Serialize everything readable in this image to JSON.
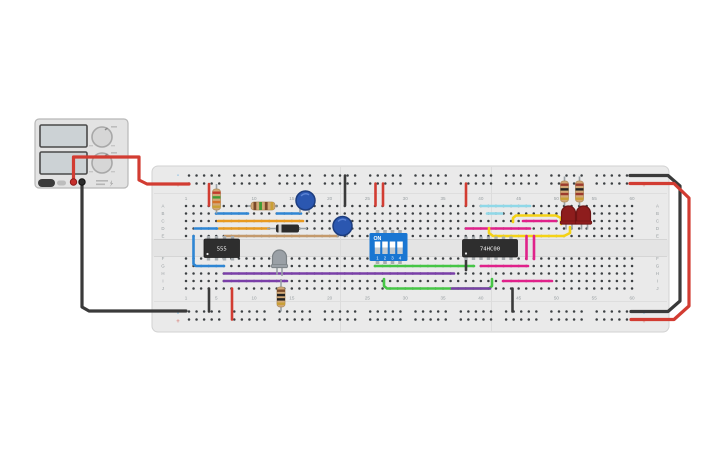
{
  "app": {
    "description": "breadboard circuit with 555 timer, 74HC00, DIP switch, LEDs and power supply"
  },
  "breadboard": {
    "row_labels": [
      "A",
      "B",
      "C",
      "D",
      "E",
      "F",
      "G",
      "H",
      "I",
      "J"
    ],
    "column_numbers": [
      "1",
      "5",
      "10",
      "15",
      "20",
      "25",
      "30",
      "35",
      "40",
      "45",
      "50",
      "55",
      "60"
    ],
    "markers": {
      "minus": "-",
      "plus": "+"
    }
  },
  "power_supply": {
    "display_count": 2,
    "knob_count": 2,
    "terminals": [
      "positive-red",
      "negative-black"
    ]
  },
  "components": {
    "ic1_label": "555",
    "ic2_label": "74HC00",
    "dip_switch": {
      "on_label": "ON",
      "positions": [
        "1",
        "2",
        "3",
        "4"
      ]
    }
  },
  "colors": {
    "board": "#eaeaea",
    "board_edge": "#d2d2d2",
    "hole": "#3c4043",
    "label": "#9aa0a3",
    "psu_body": "#e3e3e3",
    "psu_edge": "#b8b8b8",
    "psu_screen": "#ccd2d5",
    "red": "#d23c32",
    "black": "#3a3a3a",
    "blue": "#2e86d4",
    "cyan": "#8fd8e8",
    "orange": "#e89a20",
    "tan": "#c49a6c",
    "purple": "#7a3fa8",
    "green": "#46c646",
    "magenta": "#e0218a",
    "yellow": "#f4d216",
    "chip": "#2e2e2e",
    "chip_pin": "#a8adb0",
    "dip_blue": "#1976d2",
    "cap_blue": "#2b57b0",
    "cap_edge": "#1d3d7f",
    "led_red": "#8e1d1d",
    "led_gray": "#9aa0a6",
    "resistor_body": "#d2a876",
    "gold": "#c9a035",
    "leg": "#9aa2a6"
  },
  "wires": [
    {
      "name": "psu-positive-wire",
      "color": "red",
      "w": 3.2,
      "pts": [
        [
          73.5,
          180
        ],
        [
          73.5,
          157
        ],
        [
          139,
          157
        ],
        [
          139,
          180
        ],
        [
          147,
          184
        ],
        [
          189,
          184
        ]
      ]
    },
    {
      "name": "psu-negative-wire",
      "color": "black",
      "w": 3.2,
      "pts": [
        [
          82,
          186
        ],
        [
          82,
          307
        ],
        [
          89,
          311
        ],
        [
          186,
          311
        ]
      ]
    },
    {
      "name": "wrap-black-wire",
      "color": "black",
      "w": 3.2,
      "pts": [
        [
          630,
          175.5
        ],
        [
          668,
          175.5
        ],
        [
          680,
          186
        ],
        [
          680,
          301
        ],
        [
          668,
          311.5
        ],
        [
          631,
          311.5
        ]
      ]
    },
    {
      "name": "jumper-red-top-left",
      "color": "red",
      "w": 2.6,
      "pts": [
        [
          209,
          184
        ],
        [
          209,
          205.5
        ]
      ]
    },
    {
      "name": "jumper-black-col21",
      "color": "black",
      "w": 2.6,
      "pts": [
        [
          345,
          175.5
        ],
        [
          345,
          205.5
        ]
      ]
    },
    {
      "name": "jumper-red-col26a",
      "color": "red",
      "w": 2.6,
      "pts": [
        [
          375.5,
          183.5
        ],
        [
          375.5,
          205.5
        ]
      ]
    },
    {
      "name": "jumper-red-col26b",
      "color": "red",
      "w": 2.6,
      "pts": [
        [
          383,
          183.5
        ],
        [
          383,
          205.5
        ]
      ]
    },
    {
      "name": "jumper-red-col38",
      "color": "red",
      "w": 2.6,
      "pts": [
        [
          466,
          183.5
        ],
        [
          466,
          205.5
        ]
      ]
    },
    {
      "name": "wire-blue-rowB-left",
      "color": "blue",
      "w": 2.6,
      "pts": [
        [
          216,
          213.5
        ],
        [
          248,
          213.5
        ]
      ]
    },
    {
      "name": "wire-blue-rowB-right",
      "color": "blue",
      "w": 2.6,
      "pts": [
        [
          277,
          213.5
        ],
        [
          301,
          213.5
        ]
      ]
    },
    {
      "name": "wire-orange-rowC",
      "color": "orange",
      "w": 2.6,
      "pts": [
        [
          218,
          221
        ],
        [
          303,
          221
        ]
      ]
    },
    {
      "name": "wire-orange-rowD",
      "color": "orange",
      "w": 2.6,
      "pts": [
        [
          219,
          228.5
        ],
        [
          269,
          228.5
        ]
      ]
    },
    {
      "name": "wire-blue-rowD-left",
      "color": "blue",
      "w": 2.6,
      "pts": [
        [
          195,
          228.5
        ],
        [
          217,
          228.5
        ]
      ]
    },
    {
      "name": "wire-tan-rowE",
      "color": "tan",
      "w": 2.6,
      "pts": [
        [
          225,
          236
        ],
        [
          338,
          236
        ]
      ]
    },
    {
      "name": "wire-blue-vertical-left",
      "color": "blue",
      "w": 2.6,
      "pts": [
        [
          193.5,
          236
        ],
        [
          193.5,
          264
        ],
        [
          196,
          266
        ],
        [
          224,
          266
        ]
      ]
    },
    {
      "name": "wire-purple-rowH",
      "color": "purple",
      "w": 2.6,
      "pts": [
        [
          224,
          273.5
        ],
        [
          454,
          273.5
        ]
      ]
    },
    {
      "name": "wire-purple-rowI",
      "color": "purple",
      "w": 2.6,
      "pts": [
        [
          224,
          281
        ],
        [
          287,
          281
        ]
      ]
    },
    {
      "name": "jumper-black-bottom-left",
      "color": "black",
      "w": 2.6,
      "pts": [
        [
          209,
          288.5
        ],
        [
          209,
          311.5
        ]
      ]
    },
    {
      "name": "jumper-red-bottom-left",
      "color": "red",
      "w": 2.6,
      "pts": [
        [
          232,
          288.5
        ],
        [
          232,
          319.5
        ]
      ]
    },
    {
      "name": "wire-green-rowG",
      "color": "green",
      "w": 2.6,
      "pts": [
        [
          375,
          266
        ],
        [
          474,
          266
        ]
      ]
    },
    {
      "name": "wire-green-u",
      "color": "green",
      "w": 2.6,
      "pts": [
        [
          384,
          279
        ],
        [
          384,
          286
        ],
        [
          387,
          288.5
        ],
        [
          489,
          288.5
        ],
        [
          492,
          286
        ],
        [
          492,
          279
        ]
      ]
    },
    {
      "name": "wire-purple-rowJ",
      "color": "purple",
      "w": 2.6,
      "pts": [
        [
          452,
          288.5
        ],
        [
          490,
          288.5
        ]
      ]
    },
    {
      "name": "jumper-black-col38",
      "color": "black",
      "w": 2.6,
      "pts": [
        [
          466,
          258.5
        ],
        [
          466,
          270
        ]
      ]
    },
    {
      "name": "jumper-black-col44",
      "color": "black",
      "w": 2.6,
      "pts": [
        [
          512.5,
          288.5
        ],
        [
          512.5,
          311.5
        ]
      ]
    },
    {
      "name": "wire-cyan-rowA",
      "color": "cyan",
      "w": 2.6,
      "pts": [
        [
          481,
          206
        ],
        [
          530,
          206
        ]
      ]
    },
    {
      "name": "wire-cyan-rowB",
      "color": "cyan",
      "w": 2.6,
      "pts": [
        [
          487,
          213.5
        ],
        [
          502,
          213.5
        ]
      ]
    },
    {
      "name": "wire-magenta-rowD",
      "color": "magenta",
      "w": 2.6,
      "pts": [
        [
          466,
          228.5
        ],
        [
          530,
          228.5
        ]
      ]
    },
    {
      "name": "wire-magenta-rowC",
      "color": "magenta",
      "w": 2.6,
      "pts": [
        [
          523,
          221
        ],
        [
          556,
          221
        ]
      ]
    },
    {
      "name": "wire-yellow-1",
      "color": "yellow",
      "w": 2.6,
      "pts": [
        [
          513,
          222
        ],
        [
          513,
          218
        ],
        [
          516,
          215.5
        ],
        [
          556,
          215.5
        ],
        [
          561,
          218
        ],
        [
          561,
          224
        ]
      ]
    },
    {
      "name": "wire-yellow-2",
      "color": "yellow",
      "w": 2.6,
      "pts": [
        [
          489,
          228
        ],
        [
          489,
          233
        ],
        [
          493,
          236
        ],
        [
          564,
          236
        ],
        [
          570,
          233
        ],
        [
          570,
          227
        ]
      ]
    },
    {
      "name": "wire-magenta-vert1",
      "color": "magenta",
      "w": 2.6,
      "pts": [
        [
          526.5,
          236
        ],
        [
          526.5,
          259
        ]
      ]
    },
    {
      "name": "wire-magenta-vert2",
      "color": "magenta",
      "w": 2.6,
      "pts": [
        [
          534,
          236
        ],
        [
          534,
          259
        ]
      ]
    },
    {
      "name": "wire-magenta-rowG",
      "color": "magenta",
      "w": 2.6,
      "pts": [
        [
          481,
          266
        ],
        [
          528,
          266
        ]
      ]
    },
    {
      "name": "wire-magenta-rowI",
      "color": "magenta",
      "w": 2.6,
      "pts": [
        [
          503,
          281
        ],
        [
          552,
          281
        ]
      ]
    },
    {
      "name": "wrap-red-wire",
      "color": "red",
      "w": 3.2,
      "pts": [
        [
          630,
          183.5
        ],
        [
          674,
          183.5
        ],
        [
          689,
          198
        ],
        [
          689,
          306
        ],
        [
          674,
          319.5
        ],
        [
          631,
          319.5
        ]
      ]
    }
  ],
  "resistors": [
    {
      "name": "resistor-top-left",
      "orient": "v",
      "x": 216.5,
      "lead1": 184,
      "lead2": 213.5,
      "body": 189,
      "blen": 21,
      "bands": [
        "#c23b2e",
        "#3f9b35",
        "#d4722a",
        "#c9a035"
      ]
    },
    {
      "name": "resistor-rowA",
      "orient": "h",
      "y": 206,
      "lead1": 248,
      "lead2": 278,
      "body": 251,
      "blen": 24,
      "bands": [
        "#7a4a2a",
        "#3f9b35",
        "#7a4a2a",
        "#c9a035"
      ]
    },
    {
      "name": "resistor-led1",
      "orient": "v",
      "x": 564.5,
      "lead1": 176.5,
      "lead2": 205.5,
      "body": 181,
      "blen": 21,
      "bands": [
        "#9c3b2e",
        "#222222",
        "#9c3b2e",
        "#c9a035"
      ]
    },
    {
      "name": "resistor-led2",
      "orient": "v",
      "x": 579.5,
      "lead1": 176.5,
      "lead2": 205.5,
      "body": 181,
      "blen": 21,
      "bands": [
        "#9c3b2e",
        "#222222",
        "#9c3b2e",
        "#c9a035"
      ]
    },
    {
      "name": "resistor-bottom",
      "orient": "v",
      "x": 281,
      "lead1": 279,
      "lead2": 311.5,
      "body": 287,
      "blen": 20,
      "bands": [
        "#7a4a2a",
        "#222222",
        "#222222",
        "#c9a035"
      ]
    }
  ],
  "capacitors": [
    {
      "name": "capacitor-1",
      "cx": 305.5,
      "cy": 200.5,
      "r": 9.5,
      "legs": [
        [
          300,
          208,
          213
        ],
        [
          309,
          208,
          213
        ]
      ]
    },
    {
      "name": "capacitor-2",
      "cx": 342.5,
      "cy": 226,
      "r": 9.5,
      "legs": [
        [
          338,
          233,
          237
        ],
        [
          347,
          233,
          237
        ]
      ]
    }
  ],
  "diode": {
    "name": "diode",
    "y": 228.5,
    "x1": 267,
    "x2": 307,
    "bx": 276,
    "bw": 23,
    "band_x": 278.5
  },
  "leds": [
    {
      "name": "led-gray",
      "x": 272.5,
      "y": 250,
      "wd": 14,
      "ht": 17.5,
      "fill": "#9aa0a6",
      "edge": "#7c8286",
      "legs": [
        [
          277,
          267,
          275
        ],
        [
          282,
          267,
          276
        ]
      ]
    },
    {
      "name": "led-red-1",
      "x": 561.5,
      "y": 206,
      "wd": 14,
      "ht": 18,
      "fill": "#8e1d1d",
      "edge": "#6e1414",
      "legs": [
        [
          566,
          223.5,
          229.5
        ],
        [
          572,
          223.5,
          229.5
        ]
      ]
    },
    {
      "name": "led-red-2",
      "x": 576.5,
      "y": 206,
      "wd": 14,
      "ht": 18,
      "fill": "#8e1d1d",
      "edge": "#6e1414",
      "legs": [
        [
          581.5,
          223.5,
          229.5
        ],
        [
          587.5,
          223.5,
          229.5
        ]
      ]
    }
  ],
  "ics": [
    {
      "name": "ic-555",
      "labelKey": "ic1_label",
      "x": 204,
      "y": 239,
      "wd": 35.5,
      "ht": 18.5,
      "pins": [
        208.5,
        216.5,
        224.5,
        232.5
      ]
    },
    {
      "name": "ic-74hc00",
      "labelKey": "ic2_label",
      "x": 462.5,
      "y": 239.5,
      "wd": 55,
      "ht": 17.5,
      "pins": [
        466,
        473.5,
        481,
        488.5,
        496,
        503.5,
        511
      ]
    }
  ],
  "dip": {
    "name": "dip-switch",
    "x": 369.5,
    "y": 233,
    "wd": 38,
    "ht": 28,
    "slots": [
      377.5,
      385,
      392.5,
      400
    ]
  }
}
